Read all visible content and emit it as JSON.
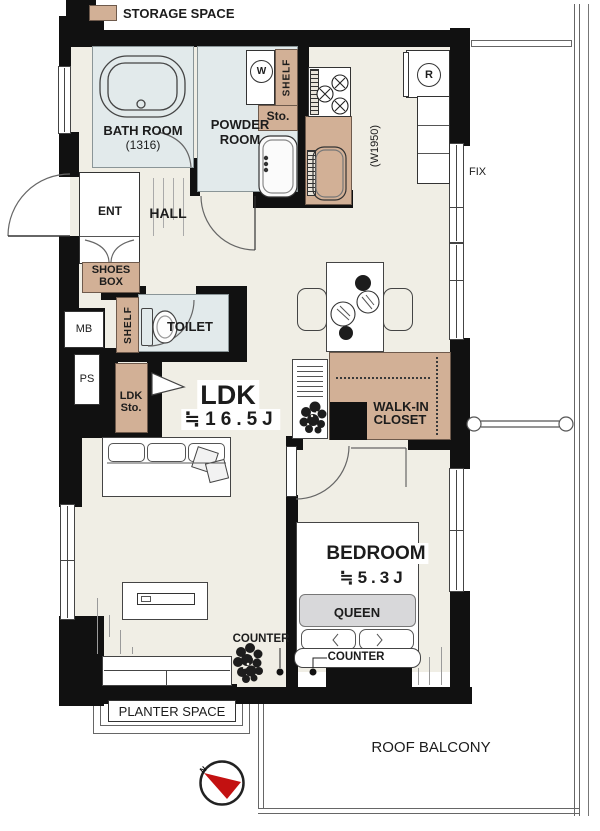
{
  "legend": {
    "label": "STORAGE SPACE"
  },
  "rooms": {
    "bath": {
      "name": "BATH ROOM",
      "size": "(1316)"
    },
    "powder": {
      "line1": "POWDER",
      "line2": "ROOM"
    },
    "entrance": {
      "label": "ENT"
    },
    "hall": {
      "label": "HALL"
    },
    "shoes_box": {
      "line1": "SHOES",
      "line2": "BOX"
    },
    "meter_box": {
      "label": "MB"
    },
    "pipe_space": {
      "label": "PS"
    },
    "toilet": {
      "label": "TOILET"
    },
    "ldk": {
      "name": "LDK",
      "size": "≒16.5J"
    },
    "walk_in_closet": {
      "line1": "WALK-IN",
      "line2": "CLOSET"
    },
    "bedroom": {
      "name": "BEDROOM",
      "size": "≒5.3J"
    },
    "roof_balcony": {
      "label": "ROOF BALCONY"
    }
  },
  "storage": {
    "shelf_powder": "SHELF",
    "sto": "Sto.",
    "shelf_toilet": "SHELF",
    "ldk_sto": {
      "line1": "LDK",
      "line2": "Sto."
    }
  },
  "fixtures": {
    "washing_machine": "W",
    "refrigerator": "R",
    "fix_window": "FIX",
    "kitchen_width": "(W1950)",
    "bed_size": "QUEEN",
    "counter_ldk": "COUNTER",
    "counter_bedroom": "COUNTER",
    "planter": "PLANTER SPACE",
    "compass_north": "N"
  },
  "colors": {
    "storage_tan": "#d2b096",
    "wet_area_blue": "#e2eaeb",
    "floor_beige": "#f0eee5",
    "wall_black": "#111111",
    "compass_red": "#c31111",
    "bed_duvet_gray": "#d8d8da"
  }
}
